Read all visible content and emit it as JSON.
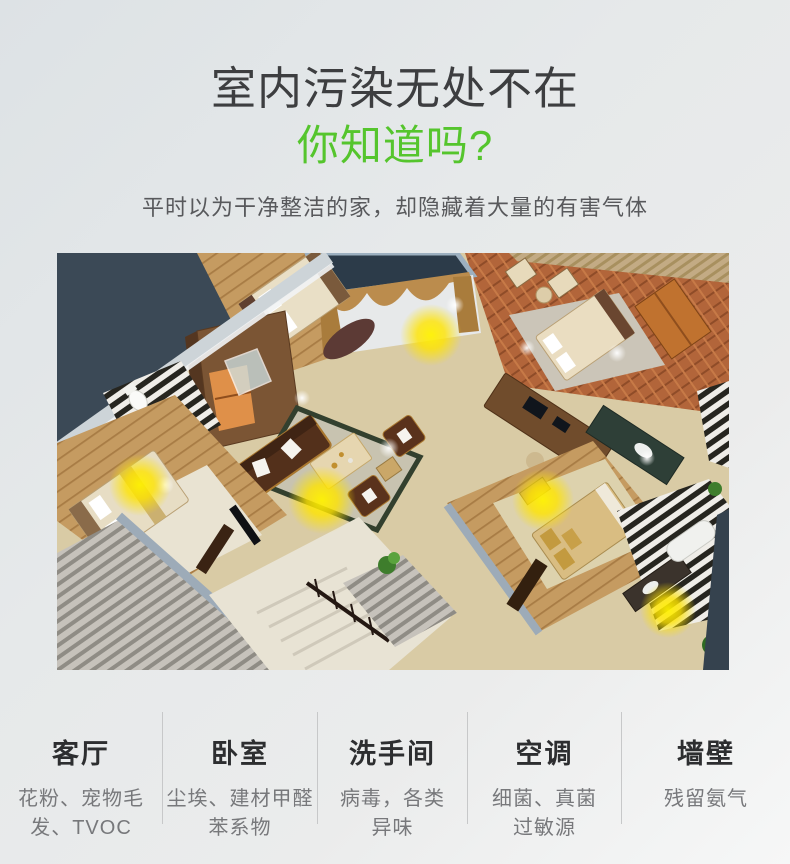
{
  "header": {
    "title": "室内污染无处不在",
    "subtitle_green": "你知道吗?",
    "description": "平时以为干净整洁的家，却隐藏着大量的有害气体",
    "accent_green": "#55c52d",
    "title_color": "#3d3e40"
  },
  "hero": {
    "name": "3d-apartment-floorplan-render",
    "pollution_glow_color": "#ffe400",
    "background_color": "#3b4956"
  },
  "bottom": {
    "columns": [
      {
        "title": "客厅",
        "lines": [
          "花粉、宠物毛",
          "发、TVOC"
        ]
      },
      {
        "title": "卧室",
        "lines": [
          "尘埃、建材甲醛",
          "苯系物"
        ]
      },
      {
        "title": "洗手间",
        "lines": [
          "病毒，各类",
          "异味"
        ]
      },
      {
        "title": "空调",
        "lines": [
          "细菌、真菌",
          "过敏源"
        ]
      },
      {
        "title": "墙壁",
        "lines": [
          "残留氨气",
          ""
        ]
      }
    ]
  }
}
